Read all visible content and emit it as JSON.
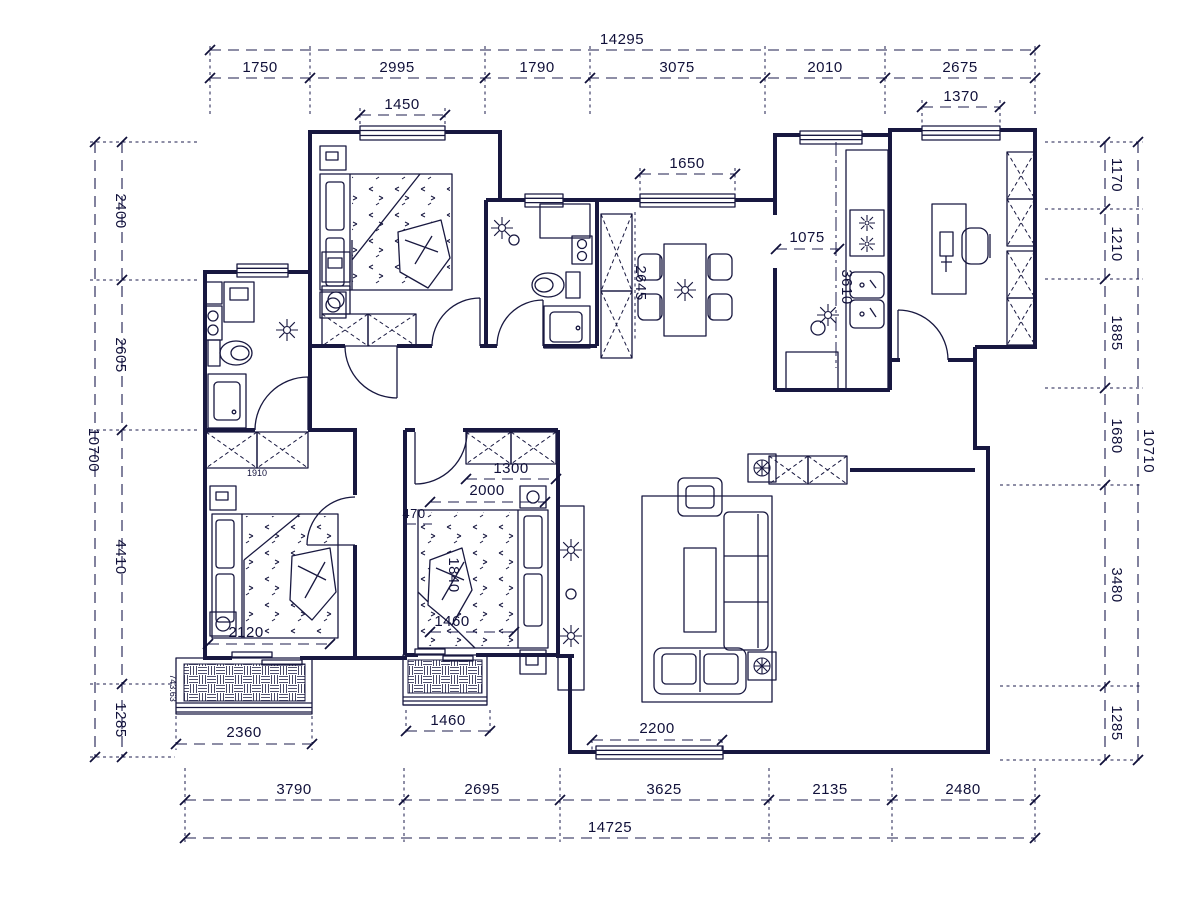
{
  "canvas": {
    "ink": "#181840",
    "background": "#ffffff"
  },
  "dims_top": {
    "total": "14295",
    "s": [
      "1750",
      "2995",
      "1790",
      "3075",
      "2010",
      "2675"
    ]
  },
  "dims_bottom": {
    "total": "14725",
    "s": [
      "3790",
      "2695",
      "3625",
      "2135",
      "2480"
    ]
  },
  "dims_left": {
    "total": "10700",
    "s": [
      "2400",
      "2605",
      "4410",
      "1285"
    ]
  },
  "dims_right": {
    "total": "10710",
    "s": [
      "1170",
      "1210",
      "1885",
      "1680",
      "3480",
      "1285"
    ]
  },
  "dims_interior": {
    "bedroom1_window": "1450",
    "hall_window": "1650",
    "study_window": "1370",
    "kitchen_width": "1075",
    "kitchen_length": "3610",
    "dining_length": "2645",
    "wardrobe_width": "1300",
    "bed2_width": "2000",
    "bed2_gap": "470",
    "bed2_length": "1840",
    "bed2_foot": "1460",
    "bed3_width": "2120",
    "closet_width": "1910",
    "balcony1_width": "2360",
    "balcony2_width": "1460",
    "living_window": "2200",
    "level_note": "743.63"
  }
}
